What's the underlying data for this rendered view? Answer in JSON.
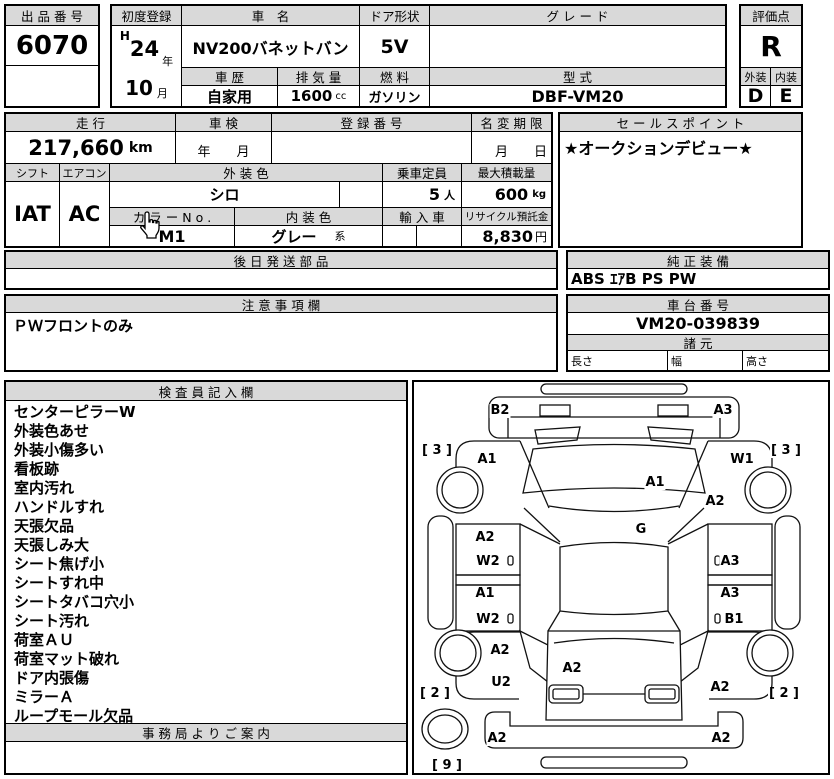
{
  "meta": {
    "header_bg": "#d9d9d9",
    "border_color": "#000000",
    "page_bg": "#ffffff"
  },
  "auction": {
    "label": "出 品 番 号",
    "number": "6070"
  },
  "first_reg": {
    "label": "初度登録",
    "era": "H",
    "year": "24",
    "year_unit": "年",
    "month": "10",
    "month_unit": "月"
  },
  "car_name": {
    "label": "車　名",
    "value": "NV200バネットバン"
  },
  "door": {
    "label": "ドア形状",
    "value": "5V"
  },
  "grade": {
    "label": "グ レ ー ド",
    "value": ""
  },
  "history": {
    "label": "車 歴",
    "value": "自家用"
  },
  "displacement": {
    "label": "排 気 量",
    "value": "1600",
    "unit": "cc"
  },
  "fuel": {
    "label": "燃 料",
    "value": "ガソリン"
  },
  "model_code": {
    "label": "型 式",
    "value": "DBF-VM20"
  },
  "score": {
    "label": "評価点",
    "value": "R",
    "exterior_label": "外装",
    "interior_label": "内装",
    "exterior": "D",
    "interior": "E"
  },
  "mileage": {
    "label": "走 行",
    "value": "217,660",
    "unit": "km"
  },
  "inspection": {
    "label": "車 検",
    "value": "年　　月"
  },
  "reg_number": {
    "label": "登 録 番 号",
    "value": ""
  },
  "name_change": {
    "label": "名 変 期 限",
    "value": "月　　日"
  },
  "sales_point": {
    "label": "セ ー ル ス ポ イ ン ト",
    "value": "★オークションデビュー★"
  },
  "shift": {
    "label": "シフト",
    "value": "IAT"
  },
  "aircon": {
    "label": "エアコン",
    "value": "AC"
  },
  "ext_color": {
    "label": "外 装 色",
    "value": "シロ"
  },
  "capacity": {
    "label": "乗車定員",
    "value": "5",
    "unit": "人"
  },
  "max_load": {
    "label": "最大積載量",
    "value": "600",
    "unit": "kg"
  },
  "color_no": {
    "label": "カ ラ ー N o .",
    "value": "M1"
  },
  "int_color": {
    "label": "内 装 色",
    "value": "グレー",
    "suffix": "系"
  },
  "import_car": {
    "label": "輸 入 車",
    "value": ""
  },
  "recycle": {
    "label": "リサイクル預託金",
    "value": "8,830",
    "unit": "円"
  },
  "later_parts": {
    "label": "後 日 発 送 部 品",
    "value": ""
  },
  "equipment": {
    "label": "純 正 装 備",
    "value": "ABS ｴｱB PS PW"
  },
  "notes": {
    "label": "注 意 事 項 欄",
    "value": "ＰＷフロントのみ"
  },
  "chassis": {
    "label": "車 台 番 号",
    "value": "VM20-039839"
  },
  "specs": {
    "label": "諸 元",
    "length_label": "長さ",
    "width_label": "幅",
    "height_label": "高さ"
  },
  "inspector": {
    "label": "検 査 員 記 入 欄",
    "items": [
      "センターピラーW",
      "外装色あせ",
      "外装小傷多い",
      "看板跡",
      "室内汚れ",
      "ハンドルすれ",
      "天張欠品",
      "天張しみ大",
      "シート焦げ小",
      "シートすれ中",
      "シートタバコ穴小",
      "シート汚れ",
      "荷室ＡＵ",
      "荷室マット破れ",
      "ドア内張傷",
      "ミラーＡ",
      "ループモール欠品"
    ]
  },
  "office": {
    "label": "事 務 局 よ り ご 案 内",
    "value": ""
  },
  "diagram": {
    "markers": [
      {
        "name": "front-bumper-left",
        "label": "B2",
        "x": 88,
        "y": 31
      },
      {
        "name": "front-bumper-right",
        "label": "A3",
        "x": 311,
        "y": 31
      },
      {
        "name": "tire-grade-front-left",
        "label": "[ 3 ]",
        "x": 25,
        "y": 71
      },
      {
        "name": "tire-grade-front-right",
        "label": "[ 3 ]",
        "x": 374,
        "y": 71
      },
      {
        "name": "front-fender-left",
        "label": "A1",
        "x": 75,
        "y": 80
      },
      {
        "name": "front-fender-right",
        "label": "W1",
        "x": 330,
        "y": 80
      },
      {
        "name": "windshield",
        "label": "A1",
        "x": 243,
        "y": 103
      },
      {
        "name": "cowl-right",
        "label": "A2",
        "x": 303,
        "y": 122
      },
      {
        "name": "roof",
        "label": "G",
        "x": 229,
        "y": 150
      },
      {
        "name": "front-door-left-upper",
        "label": "A2",
        "x": 73,
        "y": 158
      },
      {
        "name": "front-door-left",
        "label": "W2",
        "x": 76,
        "y": 182
      },
      {
        "name": "front-door-right",
        "label": "A3",
        "x": 318,
        "y": 182
      },
      {
        "name": "rear-door-left-upper",
        "label": "A1",
        "x": 73,
        "y": 214
      },
      {
        "name": "rear-door-right-upper",
        "label": "A3",
        "x": 318,
        "y": 214
      },
      {
        "name": "rear-door-left",
        "label": "W2",
        "x": 76,
        "y": 240
      },
      {
        "name": "rear-door-right",
        "label": "B1",
        "x": 322,
        "y": 240
      },
      {
        "name": "rear-fender-left",
        "label": "A2",
        "x": 88,
        "y": 271
      },
      {
        "name": "rear-gate",
        "label": "A2",
        "x": 160,
        "y": 289
      },
      {
        "name": "rear-fender-left-lower",
        "label": "U2",
        "x": 89,
        "y": 303
      },
      {
        "name": "rear-fender-right",
        "label": "A2",
        "x": 308,
        "y": 308
      },
      {
        "name": "tire-grade-rear-left",
        "label": "[ 2 ]",
        "x": 23,
        "y": 314
      },
      {
        "name": "tire-grade-rear-right",
        "label": "[ 2 ]",
        "x": 372,
        "y": 314
      },
      {
        "name": "rear-bumper-left",
        "label": "A2",
        "x": 85,
        "y": 359
      },
      {
        "name": "rear-bumper-right",
        "label": "A2",
        "x": 309,
        "y": 359
      },
      {
        "name": "spare-tire-grade",
        "label": "[ 9 ]",
        "x": 35,
        "y": 386
      }
    ]
  }
}
